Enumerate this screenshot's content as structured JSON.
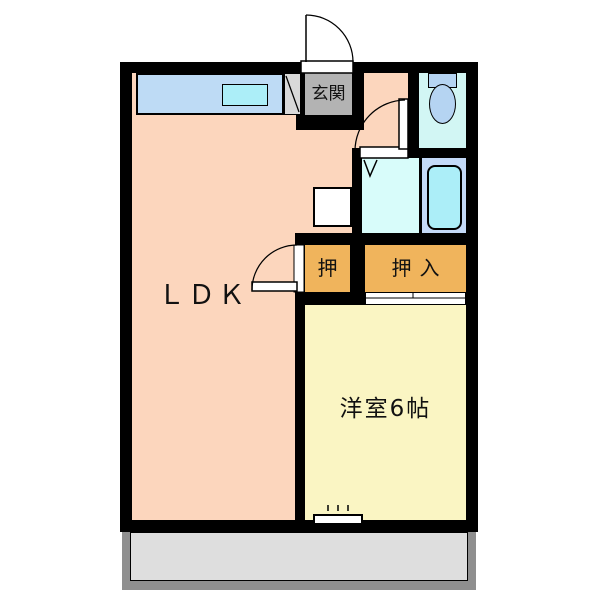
{
  "plan": {
    "type": "japanese-apartment-floorplan",
    "rooms": {
      "ldk": "ＬＤＫ",
      "western": "洋室6帖",
      "genkan": "玄関",
      "closet": "押",
      "oshiire": "押入"
    },
    "colors": {
      "wall": "#000000",
      "ldk_floor": "#fcd6bd",
      "western_floor": "#faf5c3",
      "closet_fill": "#f0b45c",
      "genkan_fill": "#b3b3b3",
      "toilet_room": "#d2f6f4",
      "washroom": "#d8fcfa",
      "bathroom": "#c4daf8",
      "fixture_blue": "#b5d4f2",
      "counter_blue": "#bedbf5",
      "sink_tub_cyan": "#aceef8",
      "balcony_frame": "#8f8f8f",
      "balcony_floor": "#dedede"
    }
  }
}
